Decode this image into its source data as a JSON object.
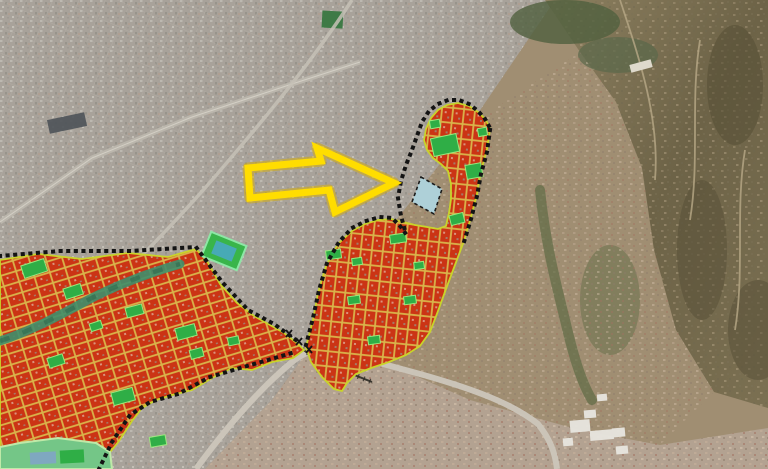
{
  "map": {
    "type": "satellite-aerial-with-urban-plan-overlay",
    "annotation_arrow": {
      "name": "highlight-arrow",
      "color": "#FFDD00",
      "halo_color": "#D8AE00",
      "direction": "right",
      "points_to": "stadium-site-parcel"
    },
    "overlay": {
      "zone_fill": "#CB3415",
      "street_color": "#D9B44A",
      "zone_border": "#C9D42A",
      "green_fill": "#2FAE46",
      "green_border": "#9BE87E",
      "field_fill": "#39B54A",
      "field_inner": "#4AA8C9",
      "park_fill": "#74C687",
      "park_border": "#BFE9A8",
      "pool_fill": "#7FA8C0",
      "stadium_fill": "#AED0D8",
      "stadium_outline": "#1C1C1C",
      "boundary_color": "#141414",
      "creek_color": "#3F8F6B",
      "zones": [
        {
          "name": "southwest-urban-blocks-zone"
        },
        {
          "name": "central-strip-zone"
        },
        {
          "name": "northeast-stadium-zone"
        }
      ]
    },
    "base": {
      "city_gray": "#A8A29A",
      "city_tan": "#B3A291",
      "suburb_tan": "#A08E72",
      "hills_dark": "#6D6347",
      "forest_dark": "#50603E",
      "park_square": "#3E7A46",
      "road_light": "#CCC6BA",
      "railway_dark": "#3A372F",
      "building_white": "#E8E6E0"
    }
  }
}
